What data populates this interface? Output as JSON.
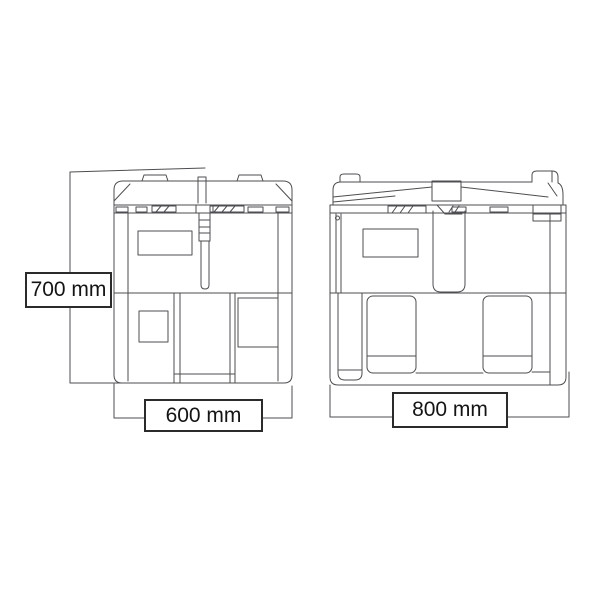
{
  "diagram": {
    "dimensions": {
      "height_label": "700 mm",
      "left_tank_width_label": "600 mm",
      "right_tank_width_label": "800 mm"
    },
    "colors": {
      "background": "#ffffff",
      "line": "#4e4e52",
      "label_border": "#2b2b2b",
      "label_text": "#141414"
    }
  }
}
